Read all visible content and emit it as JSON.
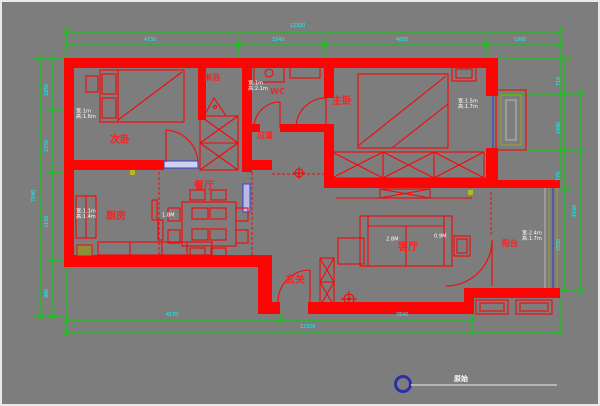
{
  "colors": {
    "bg": "#7d7d7d",
    "wall": "#fb0505",
    "dim": "#00d400",
    "dimtext": "#00ffff",
    "label": "#ff1f1f",
    "win": "#3c3cd8",
    "olive": "#9a9a2e",
    "spec": "#ffffff"
  },
  "rooms": {
    "secondary_bedroom": "次卧",
    "shower": "淋浴",
    "wc": "WC",
    "master_bedroom": "主卧",
    "corridor": "过道",
    "dining": "餐厅",
    "kitchen": "厨房",
    "entry": "玄关",
    "living": "客厅",
    "balcony": "阳台"
  },
  "window_specs": [
    {
      "w": "宽:1m",
      "h": "高:1.6m"
    },
    {
      "w": "宽:1m",
      "h": "高:2.1m"
    },
    {
      "w": "宽:1.5m",
      "h": "高:1.7m"
    },
    {
      "w": "宽:2.4m",
      "h": "高:1.7m"
    },
    {
      "w": "宽:1.1m",
      "h": "高:1.4m"
    }
  ],
  "door_labels": [
    "1.8M",
    "2.8M",
    "0.9M"
  ],
  "dims": {
    "top_total": "12320",
    "top_segments": [
      "4730",
      "3340",
      "4850",
      "1900"
    ],
    "bottom_segments": [
      "4170",
      "7840"
    ],
    "bottom_total": "12320",
    "left_total": "7540",
    "left_segments": [
      "1850",
      "2250",
      "3150",
      "980"
    ],
    "right_total": "4160",
    "right_segments": [
      "710",
      "1480",
      "770",
      "2550"
    ]
  },
  "footer": {
    "drawing_label": "原始"
  }
}
